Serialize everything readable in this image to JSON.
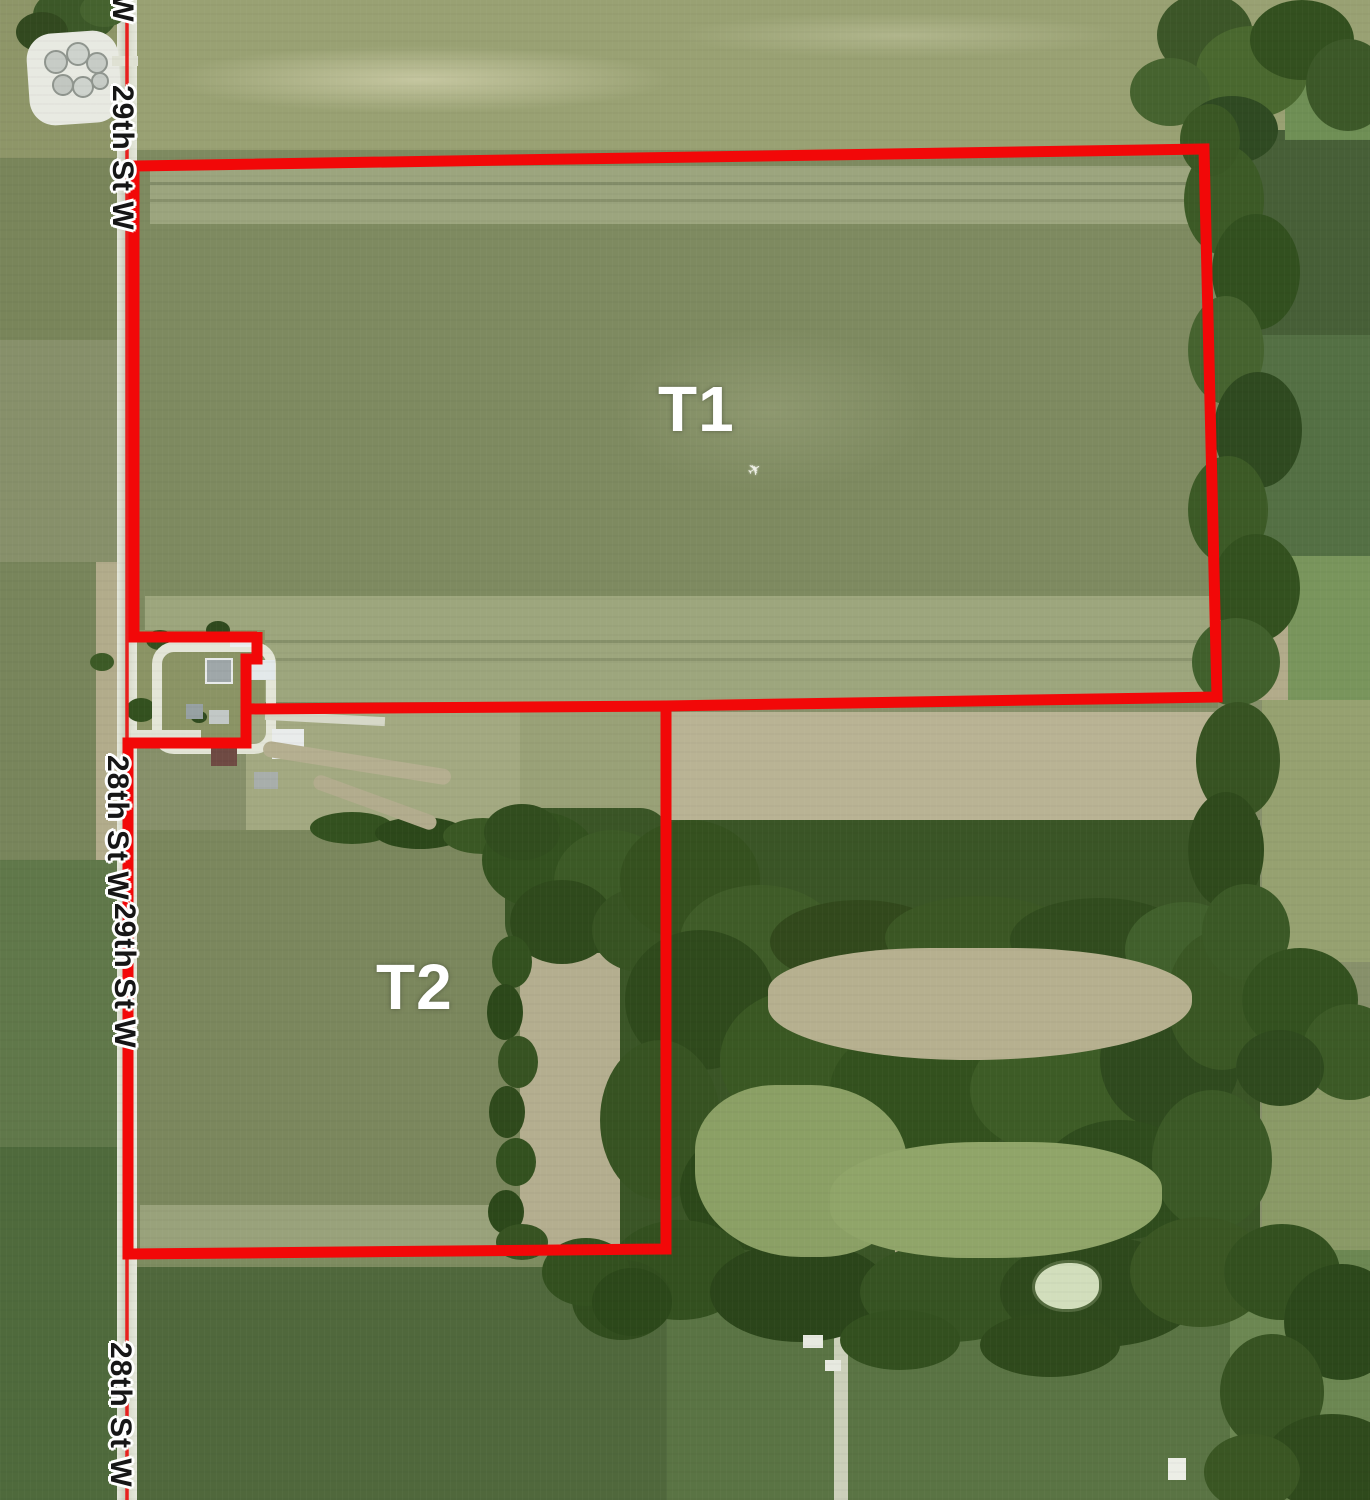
{
  "map": {
    "type": "aerial-plat-map",
    "tracts": [
      {
        "id": "T1",
        "label": "T1"
      },
      {
        "id": "T2",
        "label": "T2"
      }
    ],
    "road_labels": [
      {
        "text": "St W",
        "placement": "top-partial"
      },
      {
        "text": "29th St W",
        "placement": "upper"
      },
      {
        "text": "28th St W",
        "placement": "middle-upper"
      },
      {
        "text": "29th St W",
        "placement": "middle-lower"
      },
      {
        "text": "28th St W",
        "placement": "bottom"
      }
    ],
    "colors": {
      "tract_boundary": "#f20808",
      "road_centerline": "#e8201e",
      "tract_label_text": "#ffffff",
      "road_label_text": "#161616",
      "road_label_halo": "#ffffff"
    }
  }
}
